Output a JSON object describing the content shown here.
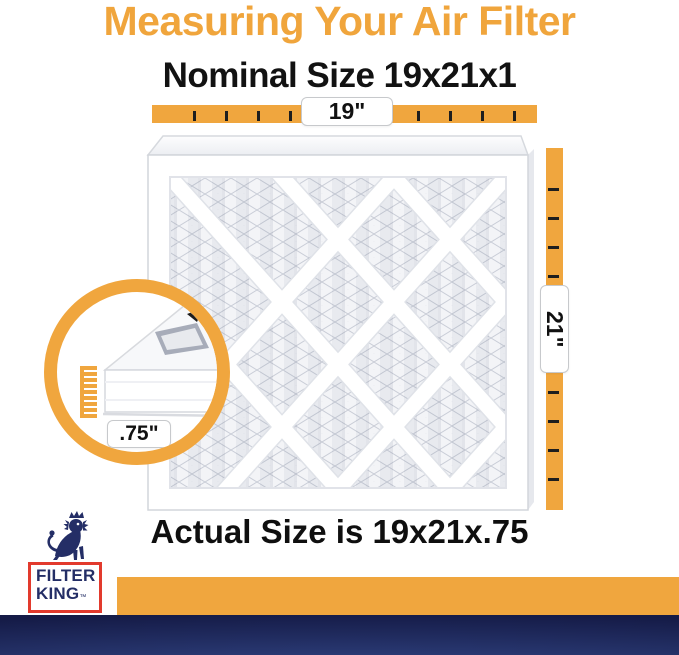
{
  "title": "Measuring Your Air Filter",
  "nominal_label": "Nominal Size 19x21x1",
  "actual_label": "Actual Size is 19x21x.75",
  "dimensions": {
    "width": "19\"",
    "height": "21\"",
    "depth": ".75\""
  },
  "logo": {
    "brand_line1": "FILTER",
    "brand_line2": "KING",
    "trademark": "™"
  },
  "colors": {
    "accent_orange": "#F0A63E",
    "title_orange": "#F0A53C",
    "text_black": "#0f0f0f",
    "logo_navy": "#242E66",
    "logo_red": "#E23A2D",
    "band_blue_dark": "#151B47",
    "band_blue_light": "#3C53A8",
    "filter_frame": "#FFFFFF",
    "mesh_gray": "#C9CDD7"
  }
}
